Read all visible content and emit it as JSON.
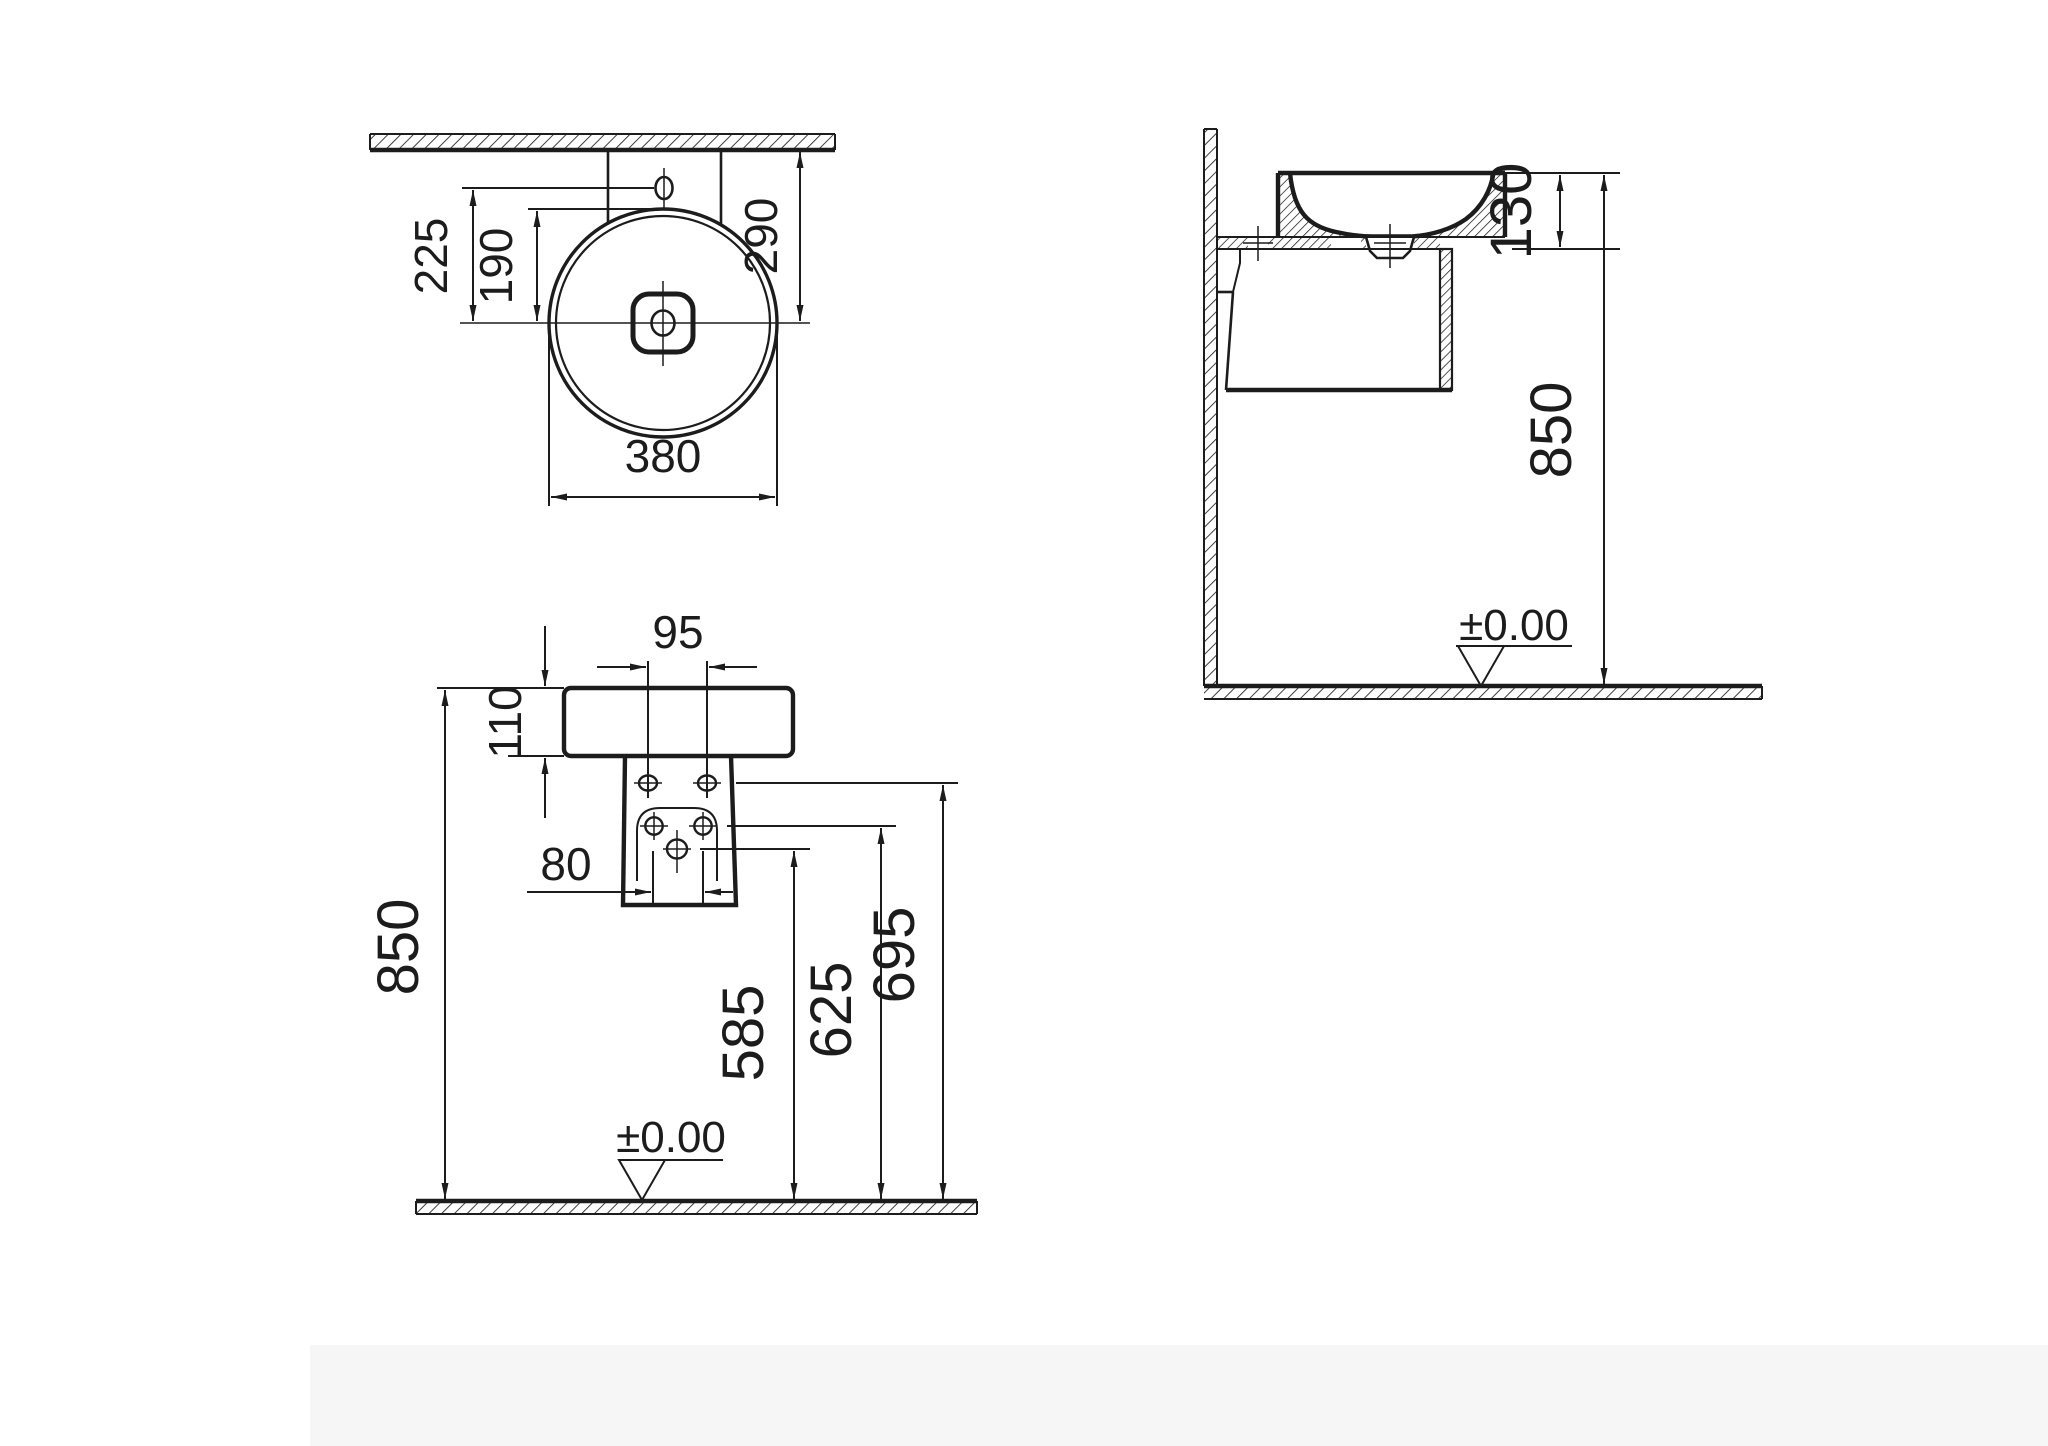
{
  "drawing": {
    "type": "technical-dimension-drawing",
    "subject": "wall-mounted round washbasin, three orthographic views",
    "colors": {
      "line": "#1c1c1c",
      "background": "#ffffff"
    },
    "views": [
      "top-plan-view",
      "front-view",
      "side-section-view"
    ]
  },
  "dims": {
    "plan_225": "225",
    "plan_190": "190",
    "plan_290": "290",
    "plan_380": "380",
    "front_95": "95",
    "front_110": "110",
    "front_80": "80",
    "front_850": "850",
    "front_585": "585",
    "front_625": "625",
    "front_695": "695",
    "side_130": "130",
    "side_850": "850",
    "datum_front": "±0.00",
    "datum_side": "±0.00"
  }
}
